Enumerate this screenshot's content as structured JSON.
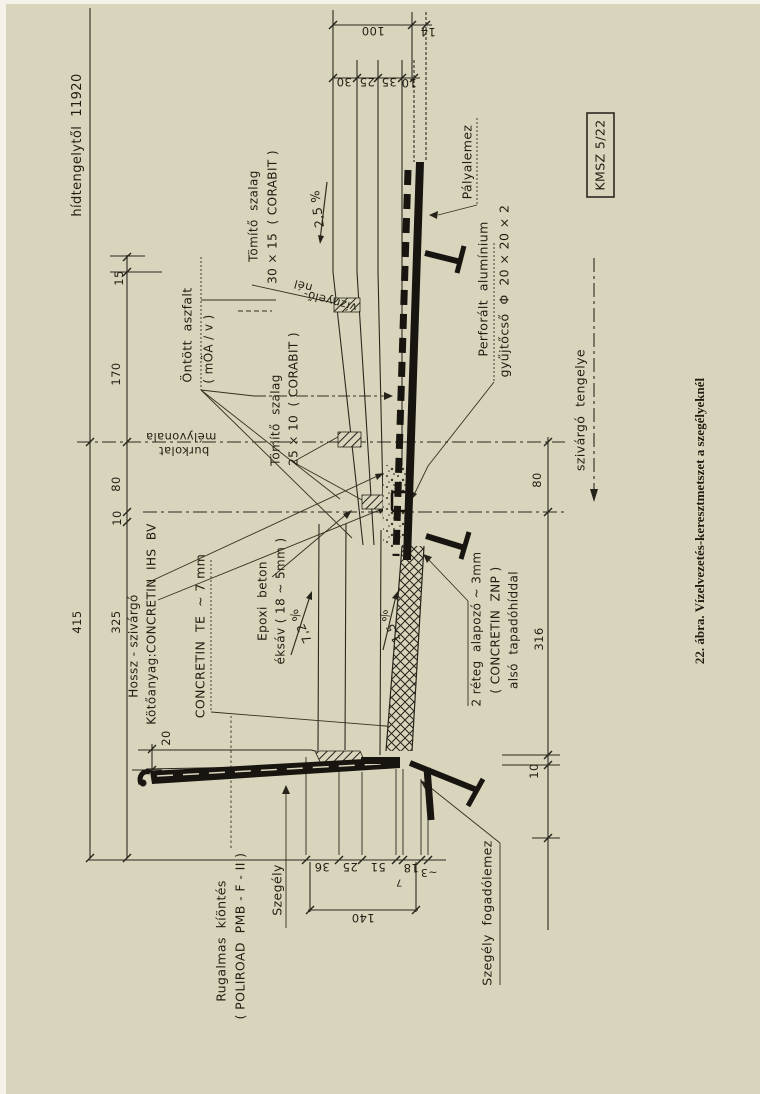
{
  "figure": {
    "caption": "22. ábra. Vízelvezetés-keresztmetszet a szegélyeknél",
    "stamp": "KMSZ 5/22",
    "paper_color": "#d9d5bc",
    "ink_color": "#2b2820"
  },
  "labels": [
    {
      "name": "dim-hidtengelytol",
      "text": "hídtengelytől  11920",
      "x": 78,
      "y": 145,
      "rot": -90,
      "fs": 13
    },
    {
      "name": "dim-15",
      "text": "15",
      "x": 119,
      "y": 278,
      "rot": -90,
      "fs": 11.5
    },
    {
      "name": "dim-170",
      "text": "170",
      "x": 116,
      "y": 374,
      "rot": -90,
      "fs": 11.5
    },
    {
      "name": "dim-80-left",
      "text": "80",
      "x": 116,
      "y": 484,
      "rot": -90,
      "fs": 11.5
    },
    {
      "name": "dim-10-left",
      "text": "10",
      "x": 117,
      "y": 518,
      "rot": -90,
      "fs": 11.5
    },
    {
      "name": "dim-415",
      "text": "415",
      "x": 77,
      "y": 622,
      "rot": -90,
      "fs": 11.5
    },
    {
      "name": "dim-325",
      "text": "325",
      "x": 116,
      "y": 622,
      "rot": -90,
      "fs": 11.5
    },
    {
      "name": "dim-20",
      "text": "20",
      "x": 166,
      "y": 738,
      "rot": -90,
      "fs": 11.5
    },
    {
      "name": "label-hossz-szivargo",
      "text": "Hossz - szivárgó",
      "x": 134,
      "y": 646,
      "rot": -90,
      "fs": 12
    },
    {
      "name": "label-kotoanyag",
      "text": "Kötőanyag:CONCRETIN  IHS  BV",
      "x": 152,
      "y": 624,
      "rot": -90,
      "fs": 12
    },
    {
      "name": "label-concretin-te",
      "text": "CONCRETIN  TE  ~ 7 mm",
      "x": 200,
      "y": 636,
      "rot": -90,
      "fs": 12.5
    },
    {
      "name": "label-epoxi-beton",
      "text": "Epoxi  beton",
      "x": 263,
      "y": 601,
      "rot": -90,
      "fs": 12
    },
    {
      "name": "label-epoxi-eksav",
      "text": "éksáv ( 18 ~ 5mm )",
      "x": 281,
      "y": 601,
      "rot": -90,
      "fs": 12
    },
    {
      "name": "slope-7-2",
      "text": "7,2 %",
      "x": 301,
      "y": 626,
      "rot": -115,
      "fs": 12
    },
    {
      "name": "label-ontott-aszfalt",
      "text": "Öntött  aszfalt",
      "x": 187,
      "y": 335,
      "rot": -90,
      "fs": 12.5
    },
    {
      "name": "label-moav",
      "text": "( mÖA / v )",
      "x": 209,
      "y": 349,
      "rot": -90,
      "fs": 12
    },
    {
      "name": "label-melyvonala",
      "text": "mélyvonala",
      "x": 181,
      "y": 437,
      "rot": 180,
      "fs": 11.5
    },
    {
      "name": "label-burkolat",
      "text": "burkolat",
      "x": 184,
      "y": 451,
      "rot": 180,
      "fs": 11.5
    },
    {
      "name": "label-tomito-szalag-25",
      "text": "Tömítő  szalag",
      "x": 276,
      "y": 420,
      "rot": -90,
      "fs": 12
    },
    {
      "name": "label-tomito-25-meret",
      "text": "25 × 10  ( CORABIT )",
      "x": 294,
      "y": 399,
      "rot": -90,
      "fs": 12
    },
    {
      "name": "label-tomito-szalag-30",
      "text": "Tömítő  szalag",
      "x": 254,
      "y": 216,
      "rot": -90,
      "fs": 12
    },
    {
      "name": "label-tomito-30-meret",
      "text": "30 × 15  ( CORABIT )",
      "x": 273,
      "y": 217,
      "rot": -90,
      "fs": 12
    },
    {
      "name": "label-viznyelo",
      "text": "víznyelő-",
      "x": 330,
      "y": 301,
      "rot": 195,
      "fs": 11.5
    },
    {
      "name": "label-viznyelo-nel",
      "text": "nél",
      "x": 303,
      "y": 286,
      "rot": 195,
      "fs": 11.5
    },
    {
      "name": "slope-2-5",
      "text": "2,5 %",
      "x": 317,
      "y": 209,
      "rot": -98,
      "fs": 12.5
    },
    {
      "name": "label-palyalemez",
      "text": "Pályalemez",
      "x": 467,
      "y": 162,
      "rot": -90,
      "fs": 12.5
    },
    {
      "name": "label-perforalt",
      "text": "Perforált  alumínium",
      "x": 483,
      "y": 289,
      "rot": -90,
      "fs": 12.5
    },
    {
      "name": "label-gyujtocso",
      "text": "gyűjtőcső  Φ  20 × 20 × 2",
      "x": 504,
      "y": 291,
      "rot": -90,
      "fs": 12.5
    },
    {
      "name": "stamp-kmsz",
      "text": "KMSZ 5/22",
      "x": 600,
      "y": 155,
      "rot": -90,
      "fs": 12.5
    },
    {
      "name": "label-szivargo-tengelye",
      "text": "szivárgó  tengelye",
      "x": 580,
      "y": 410,
      "rot": -90,
      "fs": 12.5
    },
    {
      "name": "dim-80-right",
      "text": "80",
      "x": 537,
      "y": 480,
      "rot": -90,
      "fs": 11.5
    },
    {
      "name": "dim-316",
      "text": "316",
      "x": 539,
      "y": 639,
      "rot": -90,
      "fs": 11.5
    },
    {
      "name": "label-2reteg",
      "text": "2 réteg  alapozó ~ 3mm",
      "x": 477,
      "y": 629,
      "rot": -90,
      "fs": 12
    },
    {
      "name": "label-concretin-znp",
      "text": "( CONCRETIN  ZNP )",
      "x": 496,
      "y": 630,
      "rot": -90,
      "fs": 12
    },
    {
      "name": "label-tapadohid",
      "text": "alsó  tapadóhíddal",
      "x": 514,
      "y": 630,
      "rot": -90,
      "fs": 12
    },
    {
      "name": "slope-1-5",
      "text": "1,5 %",
      "x": 390,
      "y": 626,
      "rot": -115,
      "fs": 11.5
    },
    {
      "name": "label-rugalmas",
      "text": "Rugalmas  kíöntés",
      "x": 221,
      "y": 941,
      "rot": -90,
      "fs": 12.5
    },
    {
      "name": "label-poliroad",
      "text": "( POLIROAD  PMB - F - II )",
      "x": 240,
      "y": 936,
      "rot": -90,
      "fs": 12.5
    },
    {
      "name": "label-szegely",
      "text": "Szegély",
      "x": 277,
      "y": 890,
      "rot": -90,
      "fs": 12.5
    },
    {
      "name": "label-szegely-fogadolemez",
      "text": "Szegély  fogadólemez",
      "x": 487,
      "y": 913,
      "rot": -90,
      "fs": 12.5
    },
    {
      "name": "dim-10-right",
      "text": "10",
      "x": 534,
      "y": 771,
      "rot": -90,
      "fs": 11.5
    },
    {
      "name": "figure-caption",
      "text": "22. ábra. Vízelvezetés-keresztmetszet a szegélyeknél",
      "x": 700,
      "y": 521,
      "rot": -90,
      "fs": 13,
      "serif": true
    },
    {
      "name": "dim-100",
      "text": "100",
      "x": 373,
      "y": 31,
      "rot": 180,
      "fs": 11.5
    },
    {
      "name": "dim-14",
      "text": "14",
      "x": 428,
      "y": 32,
      "rot": 180,
      "fs": 11.5
    },
    {
      "name": "dim-30",
      "text": "30",
      "x": 344,
      "y": 82,
      "rot": 180,
      "fs": 11.5
    },
    {
      "name": "dim-25-top",
      "text": "25",
      "x": 367,
      "y": 82,
      "rot": 180,
      "fs": 11.5
    },
    {
      "name": "dim-35",
      "text": "35",
      "x": 389,
      "y": 82,
      "rot": 180,
      "fs": 11.5
    },
    {
      "name": "dim-10-top",
      "text": "10",
      "x": 409,
      "y": 83,
      "rot": 180,
      "fs": 11.5
    },
    {
      "name": "dim-36",
      "text": "36",
      "x": 322,
      "y": 867,
      "rot": 180,
      "fs": 11.5
    },
    {
      "name": "dim-25-bottom",
      "text": "25",
      "x": 350,
      "y": 867,
      "rot": 180,
      "fs": 11.5
    },
    {
      "name": "dim-51",
      "text": "51",
      "x": 378,
      "y": 867,
      "rot": 180,
      "fs": 11.5
    },
    {
      "name": "dim-7",
      "text": "7",
      "x": 399,
      "y": 881,
      "rot": 180,
      "fs": 10
    },
    {
      "name": "dim-18",
      "text": "18",
      "x": 411,
      "y": 868,
      "rot": 180,
      "fs": 11.5
    },
    {
      "name": "dim-tilde3",
      "text": "~3",
      "x": 429,
      "y": 872,
      "rot": 180,
      "fs": 11
    },
    {
      "name": "dim-140",
      "text": "140",
      "x": 363,
      "y": 918,
      "rot": 180,
      "fs": 11.5
    }
  ]
}
